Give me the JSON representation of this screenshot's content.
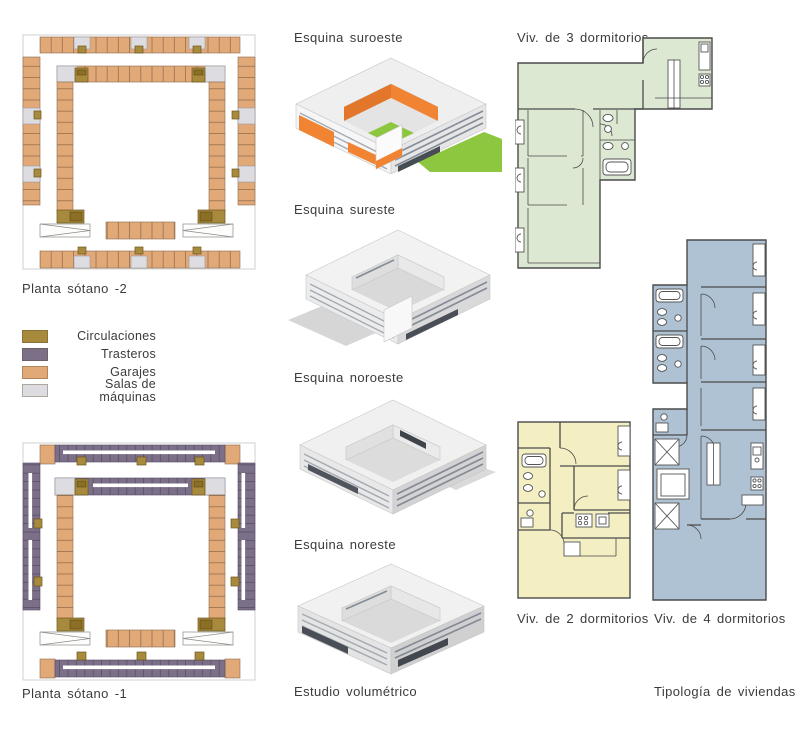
{
  "board": {
    "left": {
      "plan2_label": "Planta sótano -2",
      "plan1_label": "Planta sótano -1",
      "legend": {
        "items": [
          {
            "name": "circulaciones",
            "label": "Circulaciones",
            "color": "#a78a3c"
          },
          {
            "name": "trasteros",
            "label": "Trasteros",
            "color": "#7c6f88"
          },
          {
            "name": "garajes",
            "label": "Garajes",
            "color": "#e2a978"
          },
          {
            "name": "salas",
            "label": "Salas de máquinas",
            "color": "#dcdce1"
          }
        ]
      }
    },
    "middle": {
      "view_titles": [
        "Esquina suroeste",
        "Esquina sureste",
        "Esquina noroeste",
        "Esquina noreste"
      ],
      "caption": "Estudio volumétrico"
    },
    "right": {
      "plan3dorm_label": "Viv. de 3 dormitorios",
      "plan2dorm_label": "Viv. de 2 dormitorios",
      "plan4dorm_label": "Viv. de 4 dormitorios",
      "caption": "Tipología de viviendas",
      "fills": {
        "three": "#dce8d2",
        "two": "#f4eec3",
        "four": "#aec2d4"
      }
    },
    "colors": {
      "accent_orange": "#f08433",
      "accent_orange_dark": "#e2762a",
      "lawn_green": "#8dc63f",
      "garage_tan": "#e2a978",
      "trastero_purple": "#7c6f88",
      "circulation_olive": "#a78a3c",
      "machine_gray": "#dcdce1",
      "text": "#3b3b3b"
    }
  }
}
